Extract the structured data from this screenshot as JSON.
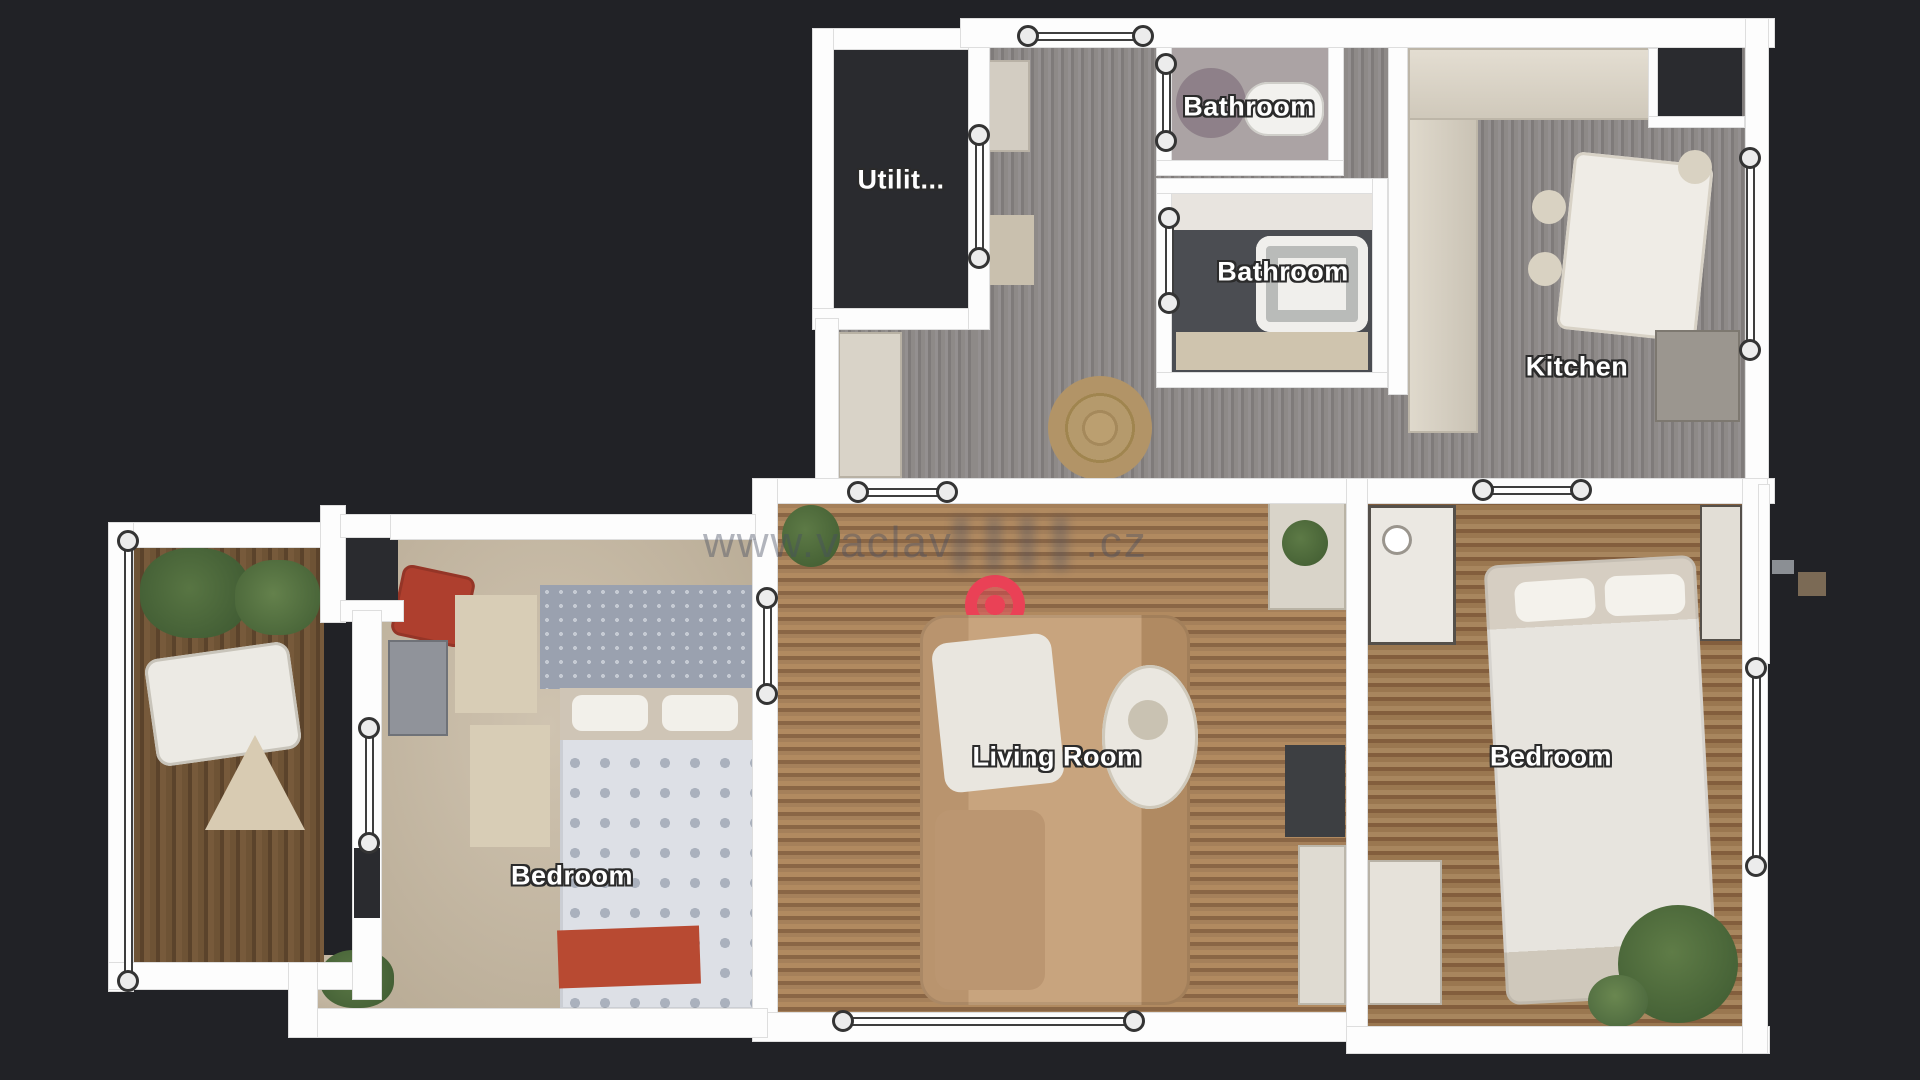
{
  "view": {
    "name": "floorplan-top-view",
    "background_color": "#212226",
    "wall_color": "#fdfdfd",
    "label_text_color": "#ffffff",
    "label_outline_color": "#2b2b2b"
  },
  "rooms": {
    "utility": {
      "label": "Utilit..."
    },
    "bathroom_top": {
      "label": "Bathroom"
    },
    "bathroom_mid": {
      "label": "Bathroom"
    },
    "kitchen": {
      "label": "Kitchen"
    },
    "living_room": {
      "label": "Living Room"
    },
    "bedroom_left": {
      "label": "Bedroom"
    },
    "bedroom_right": {
      "label": "Bedroom"
    }
  },
  "watermark": {
    "visible_text": "www.vaclav",
    "suffix": ".cz"
  },
  "position_marker": {
    "type": "current-position",
    "color": "#ea4156"
  },
  "door_markers": [
    {
      "dir": "h",
      "y": 36,
      "x1": 1028,
      "x2": 1143
    },
    {
      "dir": "v",
      "x": 979,
      "y1": 135,
      "y2": 258
    },
    {
      "dir": "v",
      "x": 1166,
      "y1": 64,
      "y2": 141
    },
    {
      "dir": "v",
      "x": 1169,
      "y1": 218,
      "y2": 303
    },
    {
      "dir": "v",
      "x": 1750,
      "y1": 158,
      "y2": 350
    },
    {
      "dir": "h",
      "y": 492,
      "x1": 858,
      "x2": 947
    },
    {
      "dir": "h",
      "y": 490,
      "x1": 1483,
      "x2": 1581
    },
    {
      "dir": "v",
      "x": 767,
      "y1": 598,
      "y2": 694
    },
    {
      "dir": "h",
      "y": 1021,
      "x1": 843,
      "x2": 1134
    },
    {
      "dir": "v",
      "x": 369,
      "y1": 728,
      "y2": 843
    },
    {
      "dir": "v",
      "x": 128,
      "y1": 541,
      "y2": 981
    },
    {
      "dir": "v",
      "x": 1756,
      "y1": 668,
      "y2": 866
    }
  ]
}
